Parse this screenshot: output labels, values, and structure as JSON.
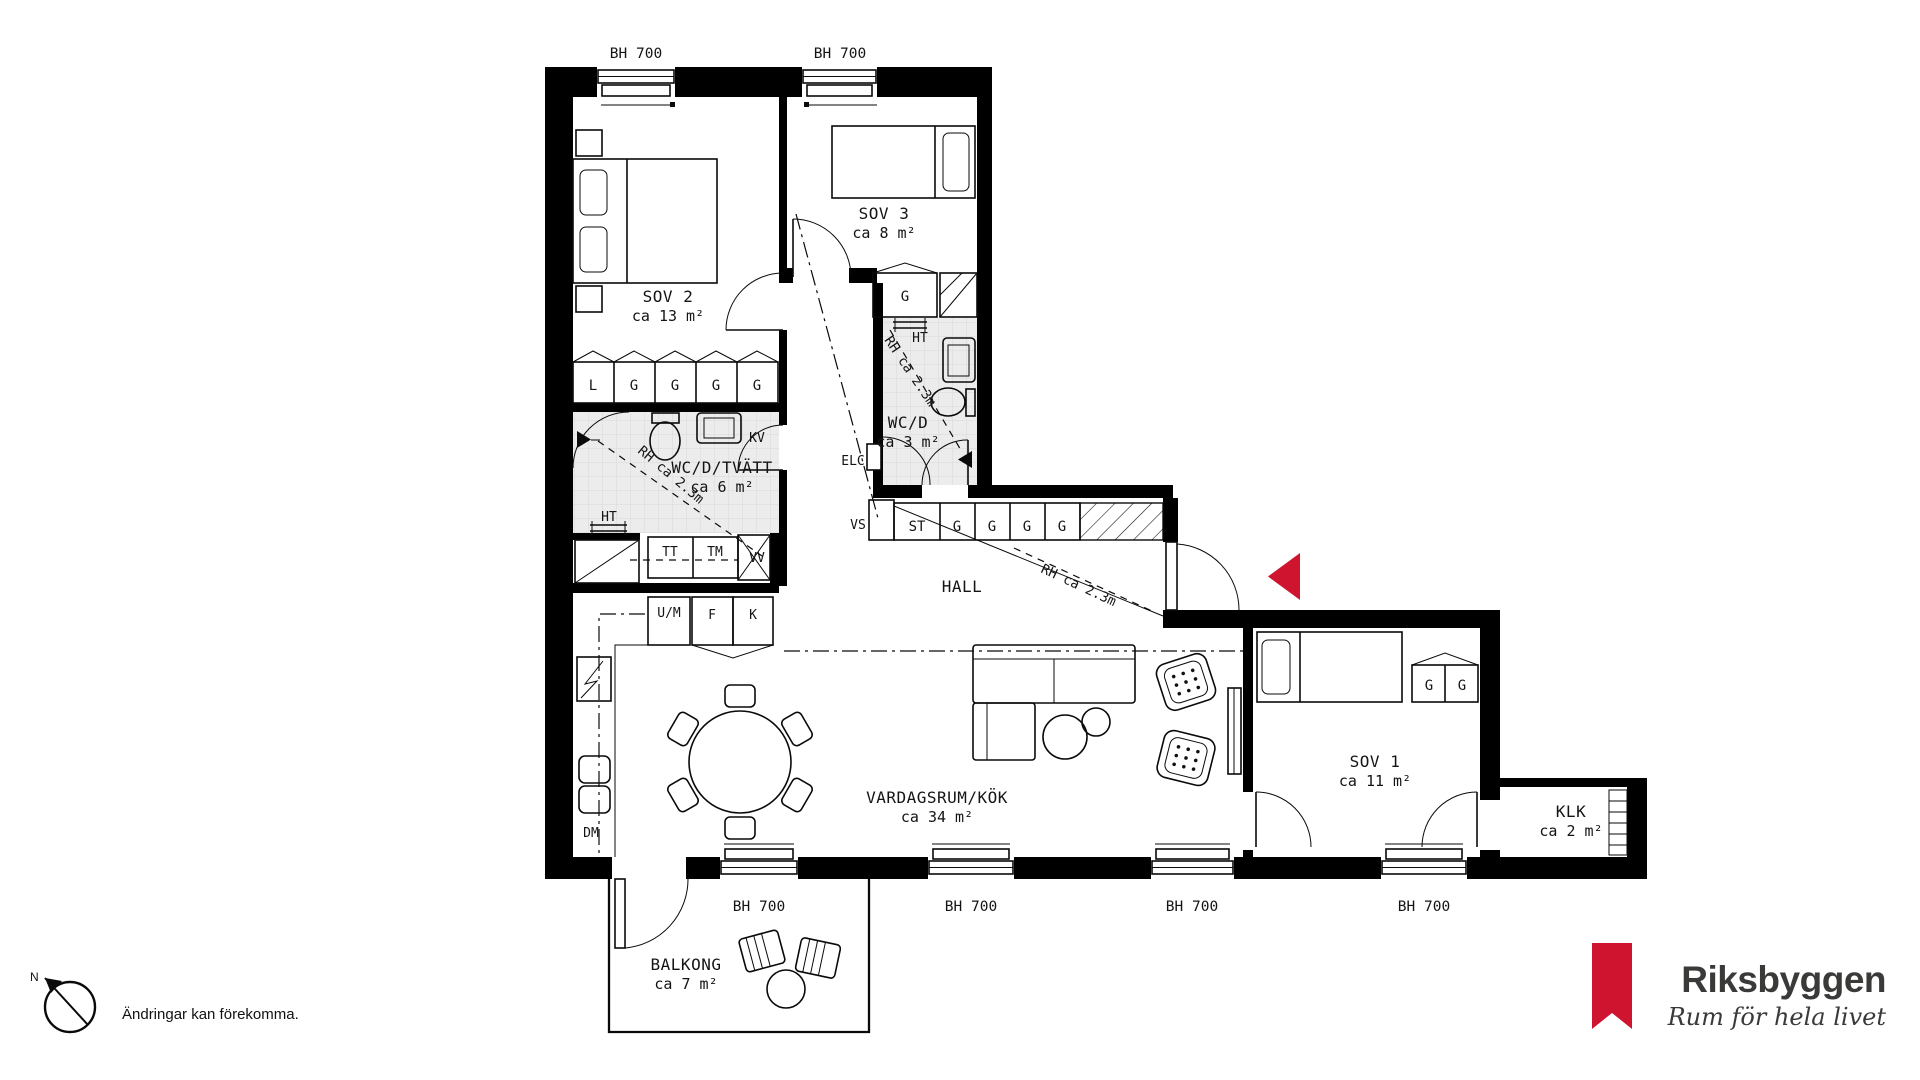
{
  "labels": {
    "window": "BH 700",
    "rh": "RH ca 2.3m"
  },
  "rooms": {
    "sov2": {
      "name": "SOV 2",
      "area": "ca 13 m²"
    },
    "sov3": {
      "name": "SOV 3",
      "area": "ca 8 m²"
    },
    "wcd": {
      "name": "WC/D",
      "area": "ca 3 m²"
    },
    "wcdtvatt": {
      "name": "WC/D/TVÄTT",
      "area": "ca 6 m²"
    },
    "hall": {
      "name": "HALL"
    },
    "vardagsrum": {
      "name": "VARDAGSRUM/KÖK",
      "area": "ca 34 m²"
    },
    "sov1": {
      "name": "SOV 1",
      "area": "ca 11 m²"
    },
    "klk": {
      "name": "KLK",
      "area": "ca 2 m²"
    },
    "balkong": {
      "name": "BALKONG",
      "area": "ca 7 m²"
    }
  },
  "fixtures": {
    "l": "L",
    "g": "G",
    "st": "ST",
    "kv": "KV",
    "ht": "HT",
    "tt": "TT",
    "tm": "TM",
    "vv": "VV",
    "vs": "VS",
    "um": "U/M",
    "f": "F",
    "k": "K",
    "dm": "DM",
    "elc": "ELC"
  },
  "footer": {
    "disclaimer": "Ändringar kan förekomma.",
    "compass": "N"
  },
  "logo": {
    "brand": "Riksbyggen",
    "tagline": "Rum för hela livet"
  },
  "colors": {
    "accent_red": "#cf1430",
    "wall": "#000000",
    "tile_fill": "#ececec",
    "tile_line": "#d8d8d8",
    "text": "#141414"
  }
}
